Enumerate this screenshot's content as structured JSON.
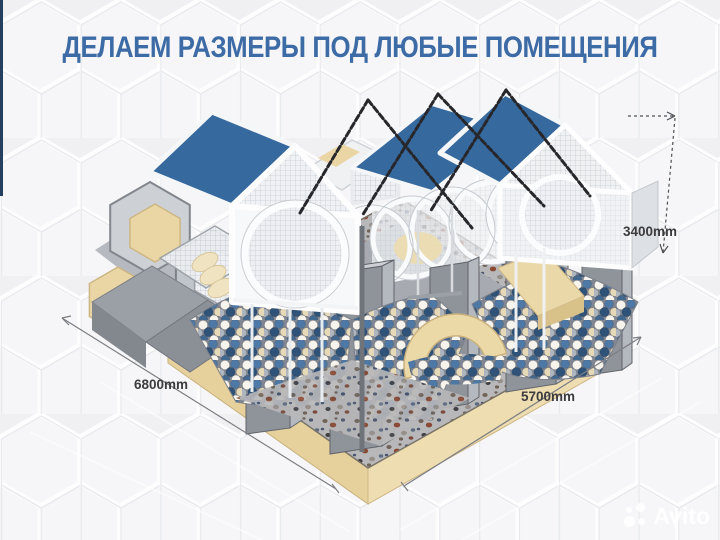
{
  "title": "ДЕЛАЕМ РАЗМЕРЫ ПОД ЛЮБЫЕ ПОМЕЩЕНИЯ",
  "dimensions": {
    "width": "6800mm",
    "depth": "5700mm",
    "height": "3400mm"
  },
  "watermark": {
    "brand": "Avito"
  },
  "colors": {
    "accent_blue": "#3d6ba6",
    "roof_blue": "#36699d",
    "beige": "#e8d5a2",
    "beige_light": "#efe0b6",
    "navy_bar": "#24405e",
    "background": "#efeff2"
  }
}
